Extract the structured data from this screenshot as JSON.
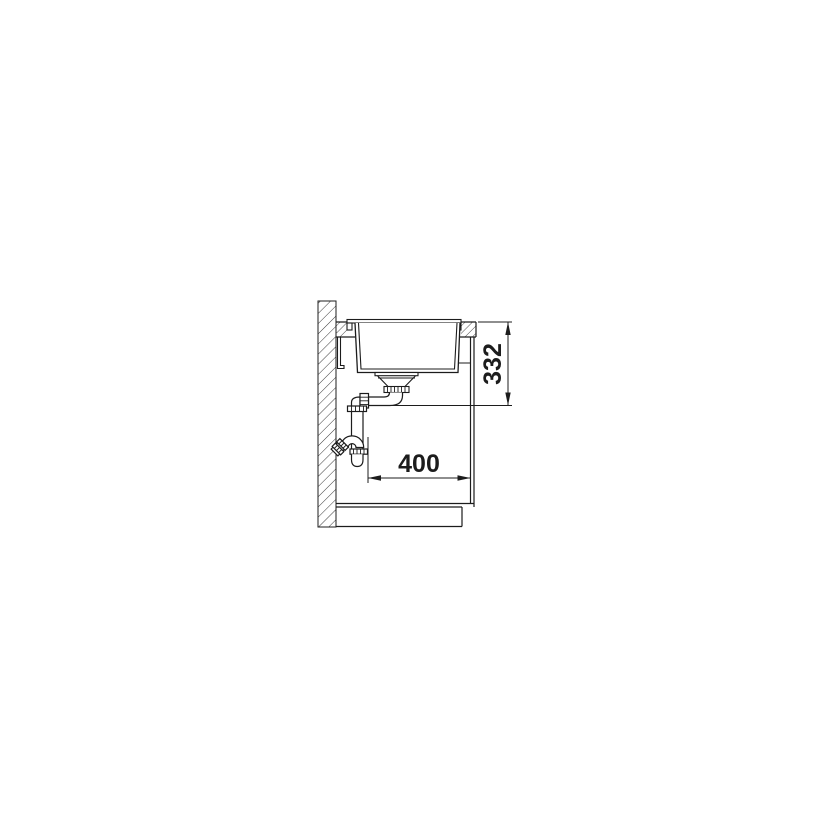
{
  "diagram": {
    "kind": "technical installation drawing — kitchen sink side cross-section with wall, countertop, bowl, drain trap, cabinet and plinth",
    "dimension_labels": {
      "depth_mm": "400",
      "height_mm": "332"
    },
    "colors": {
      "line": "#1c1c1c",
      "background": "#ffffff"
    }
  }
}
